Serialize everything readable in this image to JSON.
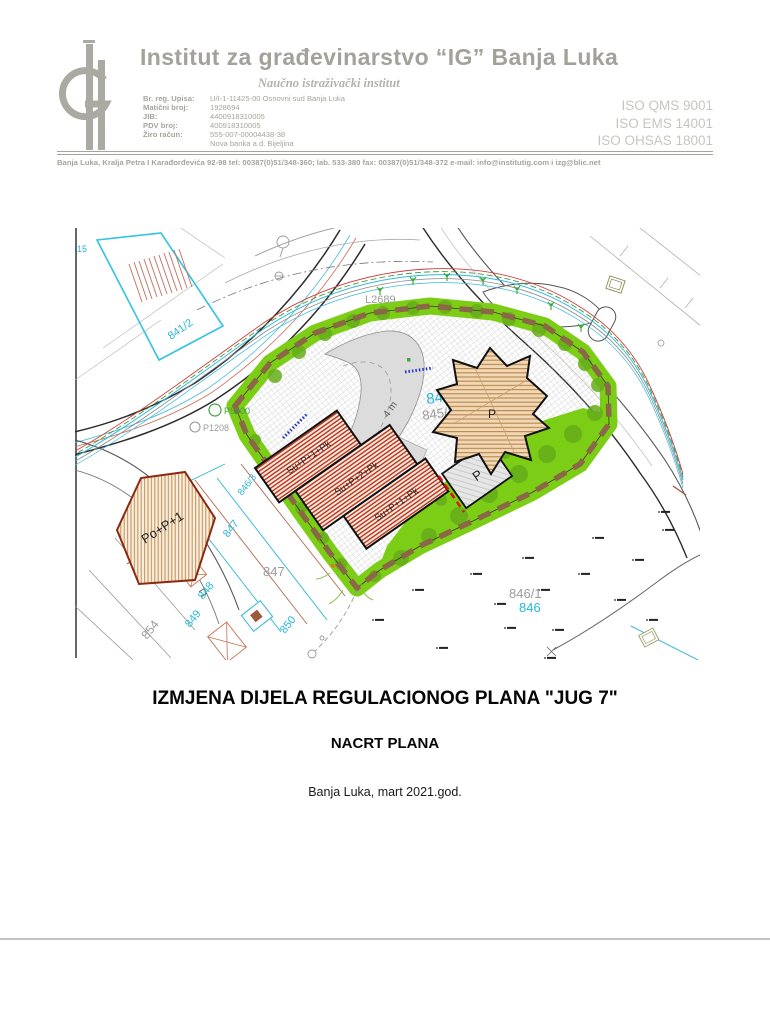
{
  "header": {
    "institute_name": "Institut za građevinarstvo “IG” Banja Luka",
    "institute_subtitle": "Naučno istraživački institut",
    "registry": [
      {
        "label": "Br. reg. Upisa:",
        "value": "U/I-1-11425-00 Osnovni sud Banja Luka"
      },
      {
        "label": "Matični broj:",
        "value": "1928694"
      },
      {
        "label": "JIB:",
        "value": "4400918310005"
      },
      {
        "label": "PDV broj:",
        "value": "400918310005"
      },
      {
        "label": "Žiro račun:",
        "value": "555-007-00004438-38"
      },
      {
        "label": "",
        "value": "Nova banka a.d. Bijeljina"
      }
    ],
    "iso_certs": [
      "ISO QMS 9001",
      "ISO EMS 14001",
      "ISO OHSAS 18001"
    ],
    "contact_line": "Banja Luka, Kralja Petra I Karađorđevića 92-98  tel: 00387(0)51/348-360;  lab. 533-380  fax: 00387(0)51/348-372   e-mail: info@institutig.com  i  izg@blic.net"
  },
  "map": {
    "labels": {
      "parcel_15": "15",
      "parcel_841_2": "841/2",
      "road_l2689": "L2689",
      "point_p5500": "P5500",
      "point_p1208": "P1208",
      "parcel_845": "845",
      "parcel_845_1": "845/1",
      "parcel_846": "846",
      "parcel_846_1": "846/1",
      "parcel_846_3": "846/3",
      "parcel_847_a": "847",
      "parcel_847_b": "847",
      "parcel_848": "848",
      "parcel_849": "849",
      "parcel_850": "850",
      "parcel_854": "854",
      "building_po_p_1": "Po+P+1",
      "building_su_p_1_pk_a": "Su+P+1+Pk",
      "building_su_p_2_pk": "Su+P+2+Pk",
      "building_su_p_1_pk_b": "Su+P+1+Pk",
      "building_p_star": "P",
      "parking_p": "P",
      "road_width_4m": "4 m"
    },
    "colors": {
      "site_green": "#7ccd15",
      "boundary_brown": "#8a6747",
      "building_red": "#bf3a1e",
      "parcel_cyan": "#27b7d7",
      "building_tan": "#e7c79c"
    }
  },
  "titles": {
    "main_title": "IZMJENA DIJELA REGULACIONOG PLANA \"JUG 7\"",
    "subtitle": "NACRT PLANA",
    "place_date": "Banja Luka, mart 2021.god."
  }
}
